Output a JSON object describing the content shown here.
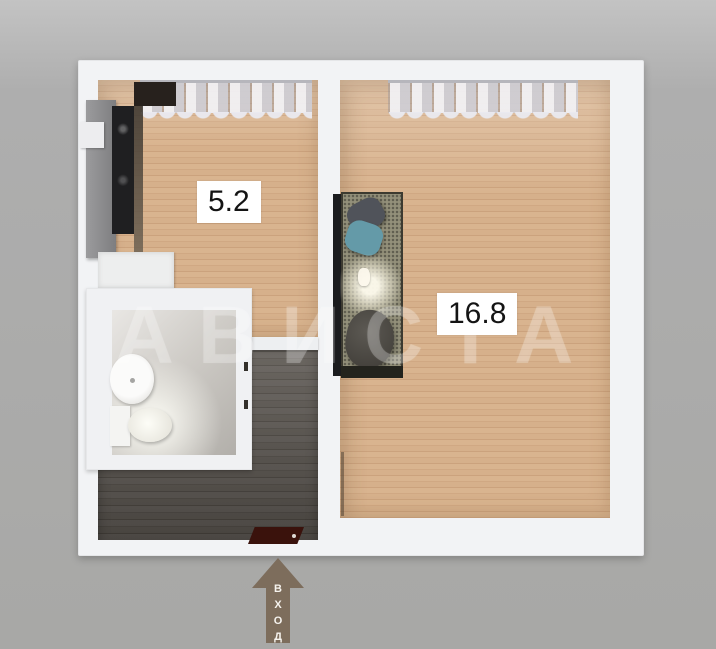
{
  "rooms": [
    {
      "id": "kitchen",
      "area_label": "5.2"
    },
    {
      "id": "living_room",
      "area_label": "16.8"
    }
  ],
  "entrance": {
    "label": "ВХОД",
    "direction": "up"
  },
  "watermark_text": "АВИСТА",
  "colors": {
    "background": "#a9a9a9",
    "wall": "#f2f3f5",
    "wood_floor": "#d4ae88",
    "hall_floor": "#56524c",
    "tile_floor": "#cfccc7",
    "rug": "#93907a",
    "pillow_teal": "#649aa8",
    "entry_mat": "#3a120c",
    "arrow": "#7d6d5c",
    "label_bg": "#ffffff",
    "label_text": "#141414"
  }
}
